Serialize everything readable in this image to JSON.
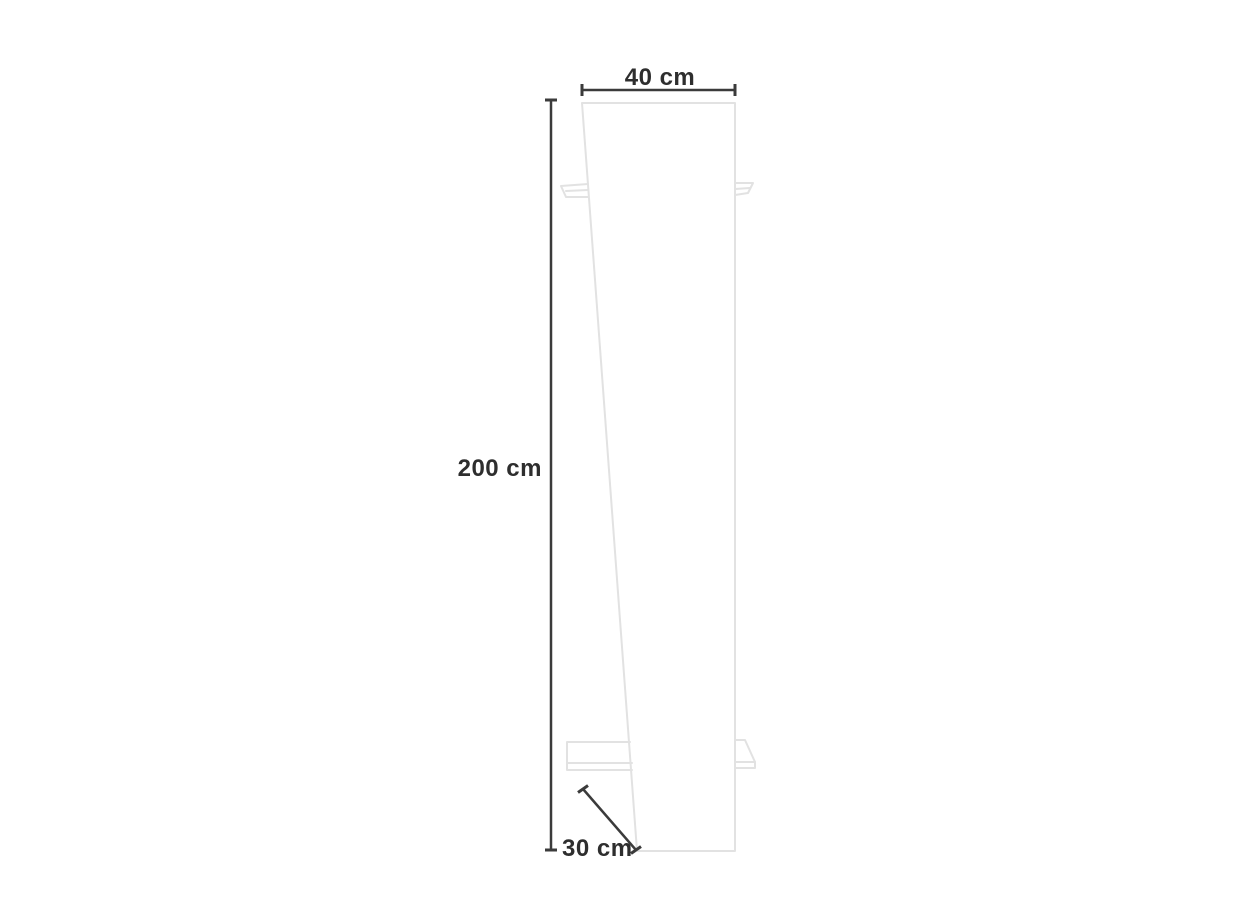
{
  "diagram": {
    "subject": "leaning-panel-coat-rack-dimension-diagram",
    "labels": {
      "width": "40 cm",
      "height": "200 cm",
      "depth": "30 cm"
    },
    "dimensions_cm": {
      "width": 40,
      "height": 200,
      "depth": 30
    }
  },
  "colors": {
    "dimension_line": "#3b3b3b",
    "furniture_outline": "#e2e2e2",
    "text": "#2e2e2e"
  }
}
